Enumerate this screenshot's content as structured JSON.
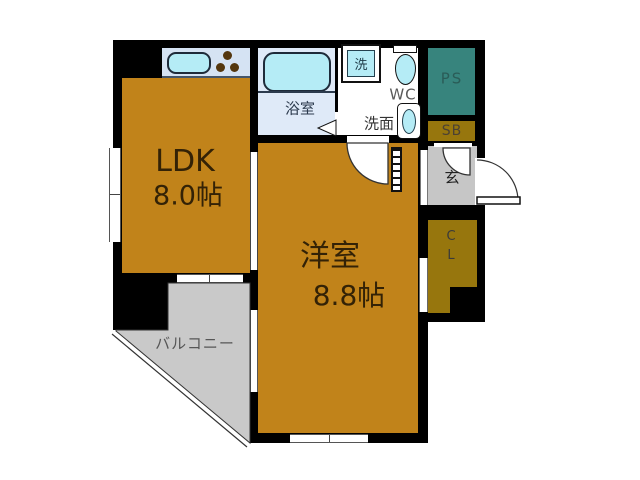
{
  "floorplan": {
    "rooms": {
      "ldk": {
        "name": "LDK",
        "size": "8.0帖"
      },
      "western_room": {
        "name": "洋室",
        "size": "8.8帖"
      },
      "bathroom": {
        "label": "浴室"
      },
      "washroom": {
        "label": "洗面"
      },
      "toilet": {
        "label": "WC"
      },
      "washing_machine": {
        "label": "洗"
      },
      "pipe_space": {
        "label": "PS"
      },
      "shoe_box": {
        "label": "SB"
      },
      "entrance": {
        "label": "玄"
      },
      "closet": {
        "label": "C\nL"
      },
      "balcony": {
        "label": "バルコニー"
      }
    },
    "colors": {
      "room": "#c1831a",
      "storage": "#97760d",
      "pipe_space": "#37847d",
      "entrance_floor": "#c6c6c6",
      "balcony": "#c9c9c9",
      "bathroom": "#dfeaf8",
      "counter": "#d5e3f3",
      "fixture": "#b5ecf6",
      "wall": "#000000"
    }
  }
}
